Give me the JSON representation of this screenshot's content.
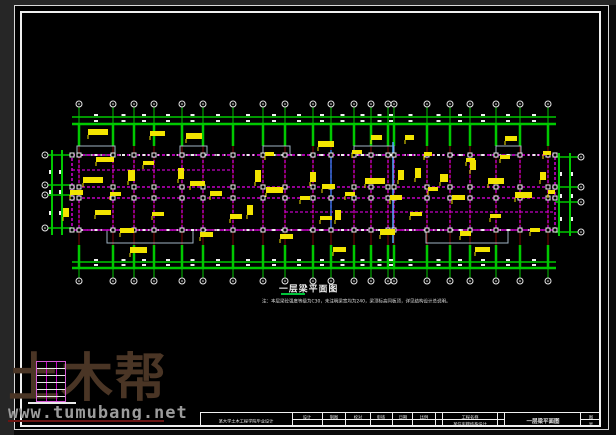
{
  "watermark": {
    "big_text": "土木帮",
    "url_text": "www.tumubang.net",
    "brand_color": "#4a3525",
    "url_color": "#9c9c9c"
  },
  "drawing_title": {
    "text": "一层梁平面图",
    "note": "注：本层梁砼强度等级为C30，未注明梁宽均为240，梁顶标高同板顶，详见结构设计总说明。"
  },
  "title_block": {
    "institution": "某大学土木工程学院毕业设计",
    "fields": {
      "f1": "设计",
      "f2": "制图",
      "f3": "校对",
      "f4": "审核",
      "f5": "日期",
      "f6": "比例"
    },
    "project_label": "工程名称",
    "project_name": "某住宅楼结构设计",
    "drawing_name": "一层梁平面图",
    "sheet_label_top": "图",
    "sheet_label_bottom": "号"
  },
  "plan": {
    "colors": {
      "green": "#00c800",
      "magenta": "#c400c4",
      "dark_red": "#7d0606",
      "yellow": "#f2e400",
      "white": "#f0f0f0",
      "cyan": "#4fa8ff",
      "blue": "#2f6fd8",
      "gray": "#9fb4c4",
      "bubble_fill": "#050505",
      "bubble_stroke": "#e6e6e6"
    },
    "grid_x": [
      79,
      113,
      134,
      154,
      182,
      203,
      233,
      263,
      285,
      313,
      331,
      354,
      371,
      388,
      394,
      427,
      450,
      470,
      496,
      520,
      548
    ],
    "plan_left": 72,
    "plan_right": 555,
    "wall_top": 155,
    "wall_bottom": 230,
    "beam_rows_full": [
      155,
      187,
      198,
      230
    ],
    "beam_rows_partial": [
      [
        170,
        72,
        233
      ],
      [
        212,
        285,
        555
      ]
    ],
    "top_dim": {
      "y1": 117,
      "y2": 124,
      "bubble_y": 104,
      "x1": 72,
      "x2": 556,
      "stem_top": 107
    },
    "bottom_dim": {
      "y1": 262,
      "y2": 268,
      "bubble_y": 281,
      "stem_bot": 278
    },
    "green_drop_top": [
      124,
      146
    ],
    "green_drop_bottom": [
      245,
      268
    ],
    "top_balconies": [
      [
        77,
        146,
        38,
        9
      ],
      [
        180,
        146,
        27,
        9
      ],
      [
        263,
        146,
        27,
        9
      ],
      [
        354,
        146,
        40,
        9
      ],
      [
        496,
        146,
        25,
        9
      ]
    ],
    "bottom_balconies": [
      [
        107,
        230,
        86,
        13
      ],
      [
        426,
        230,
        82,
        13
      ]
    ],
    "left_dim": {
      "vx": [
        52,
        62
      ],
      "y1": 150,
      "y2": 235,
      "bubble_x": 45,
      "bubbles_y": [
        155,
        185,
        195,
        228
      ]
    },
    "right_dim": {
      "vx": [
        559,
        570
      ],
      "y1": 153,
      "y2": 236,
      "bubble_x": 581,
      "bubbles_y": [
        157,
        187,
        202,
        232
      ]
    },
    "section_lines": [
      {
        "x": 393,
        "y1": 142,
        "y2": 243,
        "color_key": "cyan"
      },
      {
        "x": 331,
        "y1": 150,
        "y2": 230,
        "color_key": "blue"
      }
    ],
    "yellow_labels": [
      [
        88,
        129,
        20,
        6
      ],
      [
        150,
        131,
        15,
        5
      ],
      [
        186,
        133,
        16,
        6
      ],
      [
        318,
        141,
        16,
        6
      ],
      [
        371,
        135,
        11,
        5
      ],
      [
        405,
        135,
        9,
        5
      ],
      [
        505,
        136,
        12,
        5
      ],
      [
        96,
        157,
        18,
        5
      ],
      [
        143,
        161,
        11,
        4
      ],
      [
        265,
        152,
        9,
        4
      ],
      [
        352,
        150,
        10,
        4
      ],
      [
        424,
        152,
        8,
        4
      ],
      [
        466,
        158,
        9,
        4
      ],
      [
        500,
        155,
        10,
        4
      ],
      [
        543,
        151,
        8,
        4
      ],
      [
        83,
        177,
        20,
        6
      ],
      [
        128,
        170,
        7,
        11
      ],
      [
        178,
        168,
        6,
        11
      ],
      [
        190,
        181,
        15,
        5
      ],
      [
        255,
        170,
        6,
        12
      ],
      [
        310,
        172,
        6,
        10
      ],
      [
        322,
        184,
        13,
        5
      ],
      [
        365,
        178,
        20,
        6
      ],
      [
        398,
        170,
        6,
        10
      ],
      [
        415,
        168,
        6,
        10
      ],
      [
        440,
        174,
        8,
        8
      ],
      [
        470,
        160,
        6,
        10
      ],
      [
        488,
        178,
        16,
        6
      ],
      [
        540,
        172,
        6,
        8
      ],
      [
        70,
        190,
        13,
        5
      ],
      [
        110,
        192,
        11,
        4
      ],
      [
        210,
        191,
        12,
        5
      ],
      [
        266,
        187,
        17,
        6
      ],
      [
        300,
        196,
        10,
        4
      ],
      [
        345,
        192,
        10,
        4
      ],
      [
        390,
        195,
        12,
        5
      ],
      [
        428,
        187,
        10,
        4
      ],
      [
        452,
        195,
        13,
        5
      ],
      [
        515,
        192,
        17,
        6
      ],
      [
        548,
        190,
        7,
        4
      ],
      [
        95,
        210,
        16,
        5
      ],
      [
        152,
        212,
        12,
        4
      ],
      [
        230,
        214,
        12,
        5
      ],
      [
        247,
        205,
        6,
        10
      ],
      [
        335,
        210,
        6,
        10
      ],
      [
        320,
        216,
        12,
        4
      ],
      [
        410,
        212,
        12,
        4
      ],
      [
        490,
        214,
        11,
        4
      ],
      [
        63,
        208,
        6,
        9
      ],
      [
        120,
        228,
        14,
        5
      ],
      [
        200,
        232,
        13,
        5
      ],
      [
        280,
        234,
        13,
        5
      ],
      [
        380,
        229,
        15,
        6
      ],
      [
        460,
        231,
        11,
        5
      ],
      [
        530,
        228,
        10,
        4
      ],
      [
        130,
        247,
        17,
        6
      ],
      [
        333,
        247,
        13,
        5
      ],
      [
        475,
        247,
        15,
        5
      ]
    ]
  }
}
